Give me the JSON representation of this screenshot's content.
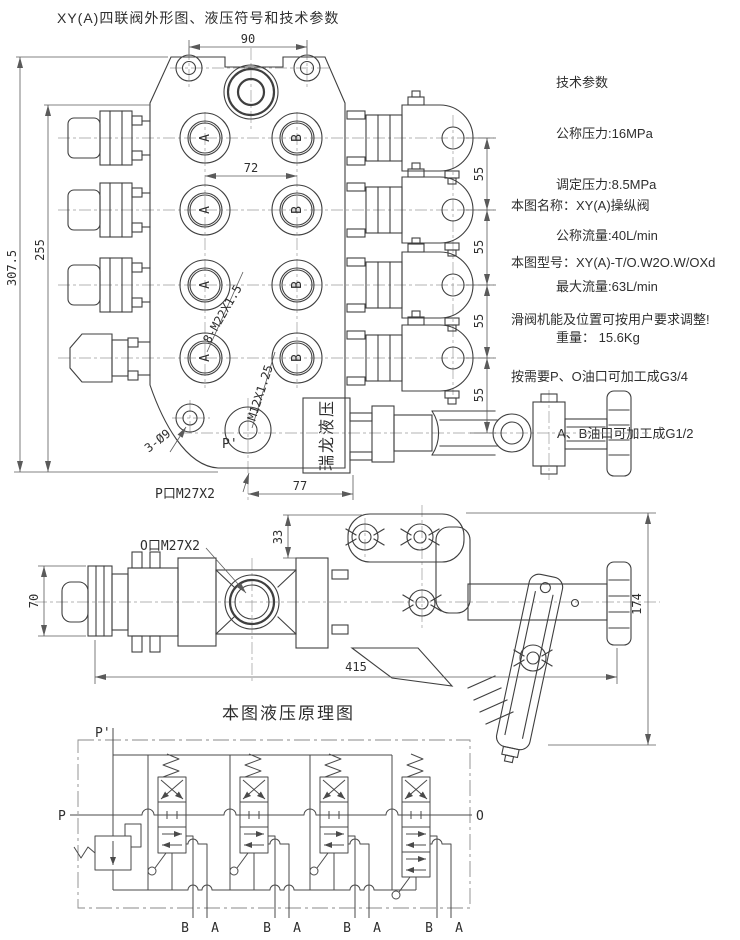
{
  "page": {
    "title": "XY(A)四联阀外形图、液压符号和技术参数"
  },
  "tech_params": {
    "header": "技术参数",
    "lines": [
      "公称压力:16MPa",
      "调定压力:8.5MPa",
      "公称流量:40L/min",
      "最大流量:63L/min",
      "重量： 15.6Kg"
    ]
  },
  "notes": {
    "name": "本图名称：XY(A)操纵阀",
    "model": "本图型号：XY(A)-T/O.W2O.W/OXd",
    "line3": "滑阀机能及位置可按用户要求调整!",
    "line4": "按需要P、O油口可加工成G3/4",
    "line5": "A、B油口可加工成G1/2"
  },
  "front_view": {
    "dims": {
      "top_width": "90",
      "port_spacing": "72",
      "inner_height": "255",
      "outer_height": "307.5",
      "section_spacing": "55",
      "bottom_offset": "77"
    },
    "labels": {
      "thread_ab": "8-M22X1.5",
      "thread_pilot": "M12X1.25",
      "mount_holes": "3-Ø9",
      "pilot_port": "P'",
      "p_port": "P口M27X2",
      "brand": "瑞龙液压",
      "port_a": "A",
      "port_b": "B"
    }
  },
  "side_view": {
    "dims": {
      "left_height": "70",
      "bracket_offset": "33",
      "total_length": "415",
      "total_height": "174"
    },
    "labels": {
      "o_port": "O口M27X2"
    }
  },
  "schematic": {
    "title": "本图液压原理图",
    "labels": {
      "p_prime": "P'",
      "p": "P",
      "o": "O",
      "a": "A",
      "b": "B"
    }
  },
  "colors": {
    "drawing_line": "#3f3f3f",
    "centerline": "#9a9a9a",
    "dimension": "#5a5a5a",
    "background": "#ffffff"
  }
}
